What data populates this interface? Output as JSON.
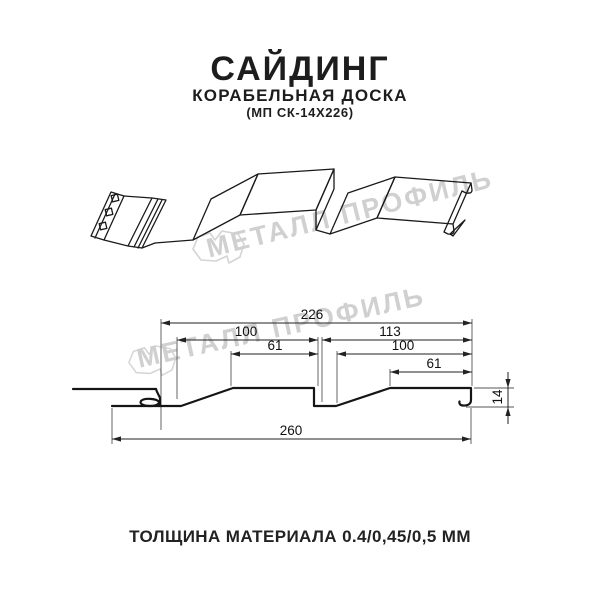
{
  "header": {
    "title": "САЙДИНГ",
    "subtitle": "КОРАБЕЛЬНАЯ ДОСКА",
    "model": "(МП СК-14Х226)"
  },
  "watermark": {
    "brand": "МЕТАЛЛ ПРОФИЛЬ",
    "logo_icon": "metall-profil-logo-icon"
  },
  "section": {
    "dims": {
      "d226": "226",
      "d100_left": "100",
      "d113": "113",
      "d61_left": "61",
      "d100_right": "100",
      "d61_right": "61",
      "d260": "260",
      "d14": "14"
    }
  },
  "footer": {
    "caption": "ТОЛЩИНА МАТЕРИАЛА 0.4/0,45/0,5 ММ"
  },
  "colors": {
    "line": "#1a1a1a",
    "dimension": "#333333",
    "watermark": "#d0d0d0",
    "text": "#1d1d1d"
  }
}
